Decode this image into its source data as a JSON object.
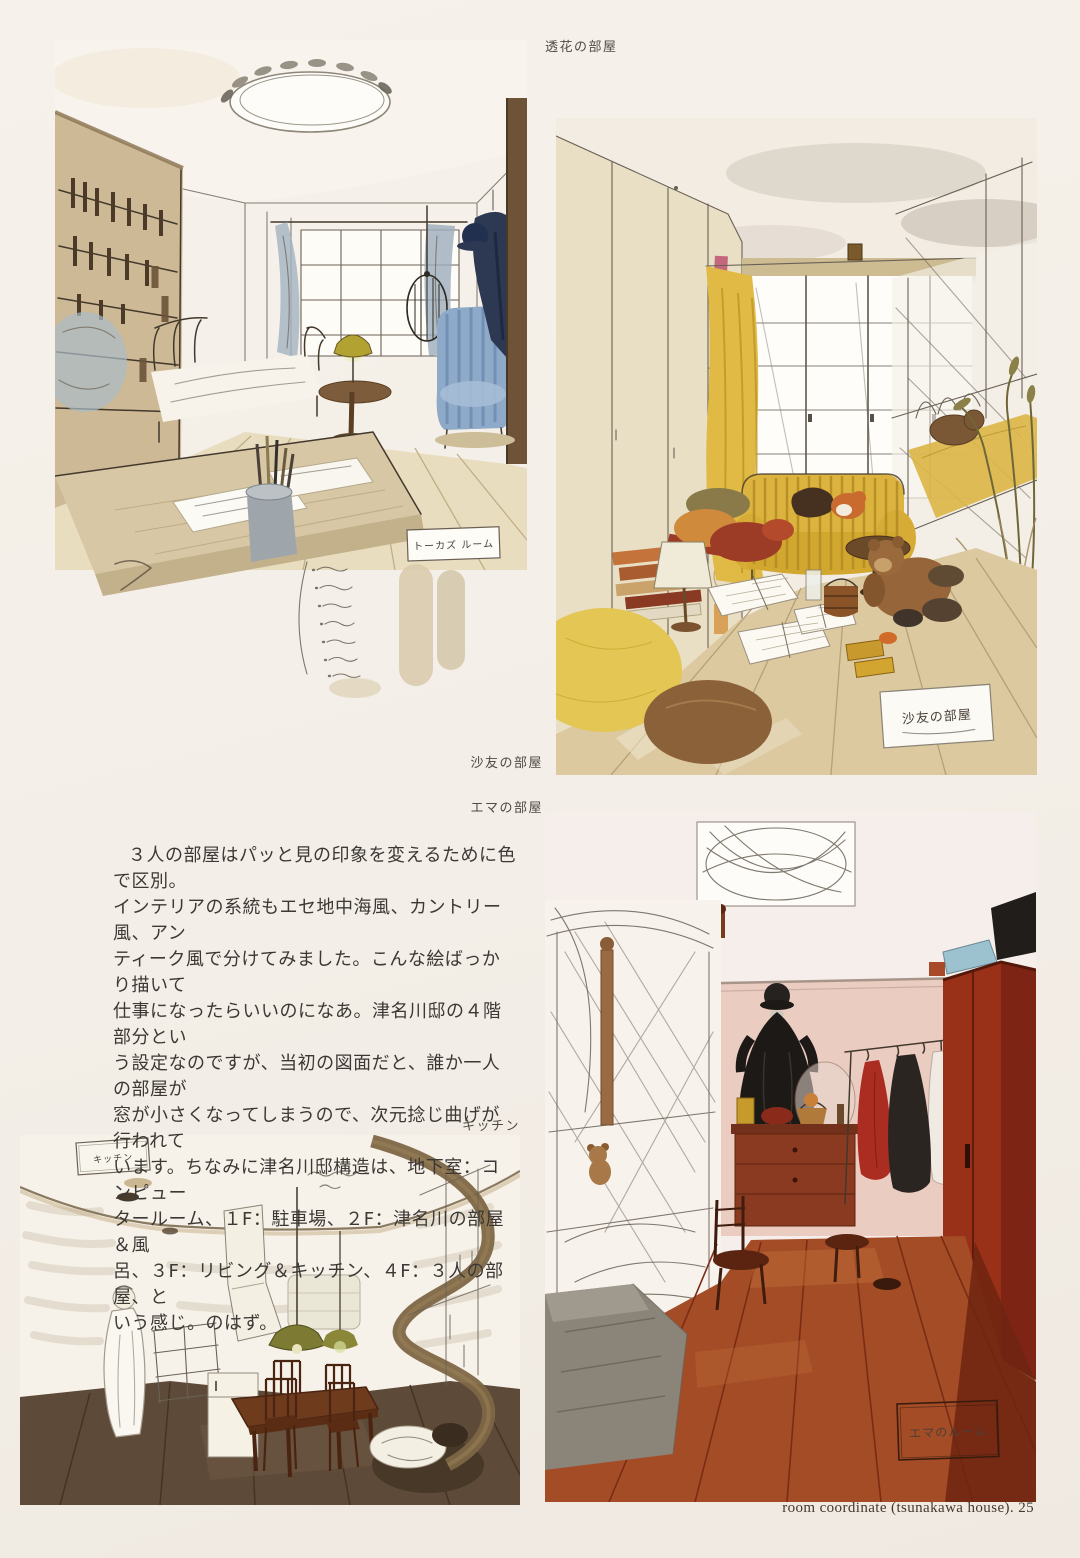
{
  "labels": {
    "touka": "透花の部屋",
    "sayu": "沙友の部屋",
    "emma": "エマの部屋",
    "kitchen": "キッチン"
  },
  "body_text": {
    "lines": [
      "３人の部屋はパッと見の印象を変えるために色で区別。",
      "インテリアの系統もエセ地中海風、カントリー風、アン",
      "ティーク風で分けてみました。こんな絵ばっかり描いて",
      "仕事になったらいいのになあ。津名川邸の４階部分とい",
      "う設定なのですが、当初の図面だと、誰か一人の部屋が",
      "窓が小さくなってしまうので、次元捻じ曲げが行われて",
      "います。ちなみに津名川邸構造は、地下室：コンピュー",
      "タールーム、１F：駐車場、２F：津名川の部屋＆風",
      "呂、３F：リビング＆キッチン、４F：３人の部屋、と",
      "いう感じ。のはず。"
    ]
  },
  "handwritten": {
    "touka_box": "トーカズ ルーム",
    "sayu_sign": "沙友の部屋",
    "emma_box": "エマのルーム",
    "kitchen_box": "キッチン"
  },
  "footer": "room coordinate (tsunakawa house). 25",
  "colors": {
    "page_background": "#f3eee7",
    "label_text": "#4f4a43",
    "body_text": "#3b3835",
    "touka_accent_blue": "#8fa9c9",
    "touka_coat_navy": "#2d3852",
    "sayu_accent_yellow": "#ddb340",
    "sayu_floor_tan": "#dcc9a0",
    "emma_wall_pink": "#ebccc1",
    "emma_wardrobe_red": "#993018",
    "emma_floor_red": "#a44c26",
    "kitchen_floor_brown": "#5d4a38"
  }
}
